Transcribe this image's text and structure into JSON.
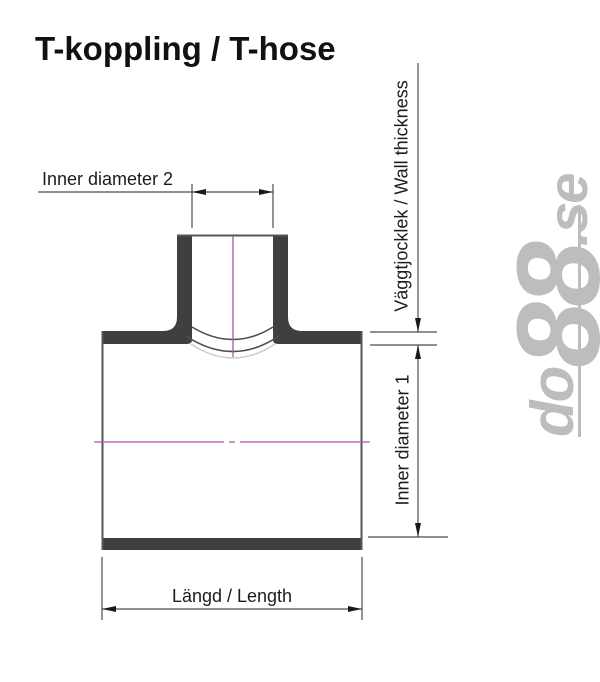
{
  "page": {
    "title": "T-koppling / T-hose"
  },
  "diagram": {
    "type": "technical-drawing",
    "subject": "T pipe coupling cross-section with dimension callouts",
    "labels": {
      "inner_diameter_2": "Inner diameter 2",
      "wall_thickness": "Väggtjocklek / Wall thickness",
      "inner_diameter_1": "Inner diameter 1",
      "length": "Längd / Length"
    },
    "colors": {
      "wall_fill": "#3f3f3f",
      "outline": "#555555",
      "dimension_line": "#4d4d4d",
      "arrow": "#1a1a1a",
      "centerline_magenta": "#b351b3",
      "faint_arc": "#c4c4c4",
      "label_text": "#1c1c1c"
    }
  },
  "watermark": {
    "prefix": "do",
    "number": "88",
    "suffix": ".se",
    "color": "#bdbdbd"
  }
}
